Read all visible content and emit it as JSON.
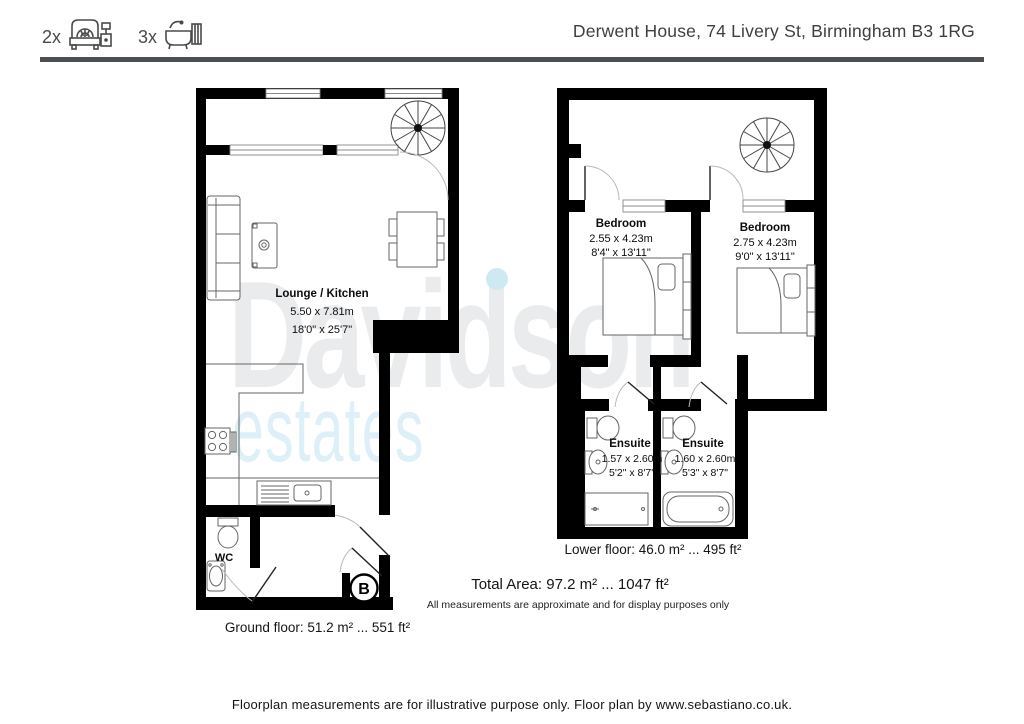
{
  "header": {
    "bed_count": "2x",
    "bath_count": "3x",
    "address": "Derwent House, 74 Livery St, Birmingham B3 1RG"
  },
  "watermark": {
    "line1": "Davidson",
    "line2": "estates"
  },
  "ground_floor": {
    "room": {
      "name": "Lounge / Kitchen",
      "metric": "5.50 x 7.81m",
      "imperial": "18'0\" x 25'7\""
    },
    "wc_label": "WC",
    "boiler_label": "B",
    "area_label": "Ground floor: 51.2 m² ... 551 ft²"
  },
  "lower_floor": {
    "bedroom1": {
      "name": "Bedroom",
      "metric": "2.55 x 4.23m",
      "imperial": "8'4\" x 13'11\""
    },
    "bedroom2": {
      "name": "Bedroom",
      "metric": "2.75 x 4.23m",
      "imperial": "9'0\" x 13'11\""
    },
    "ensuite1": {
      "name": "Ensuite",
      "metric": "1.57 x 2.60m",
      "imperial": "5'2\" x 8'7\""
    },
    "ensuite2": {
      "name": "Ensuite",
      "metric": "1.60 x 2.60m",
      "imperial": "5'3\" x 8'7\""
    },
    "area_label": "Lower floor: 46.0 m² ... 495 ft²"
  },
  "summary": {
    "total_area": "Total Area: 97.2 m² ... 1047 ft²",
    "disclaimer": "All measurements are approximate and for display purposes only"
  },
  "footer": {
    "note": "Floorplan measurements are for illustrative purpose only. Floor plan by www.sebastiano.co.uk."
  },
  "colors": {
    "wall": "#000000",
    "furniture_stroke": "#666666",
    "door_arc": "#b9b9b9",
    "header_text": "#3c4043",
    "header_rule": "#4b4f51",
    "watermark_gray": "#e9ebec",
    "watermark_blue": "#def0f7"
  }
}
